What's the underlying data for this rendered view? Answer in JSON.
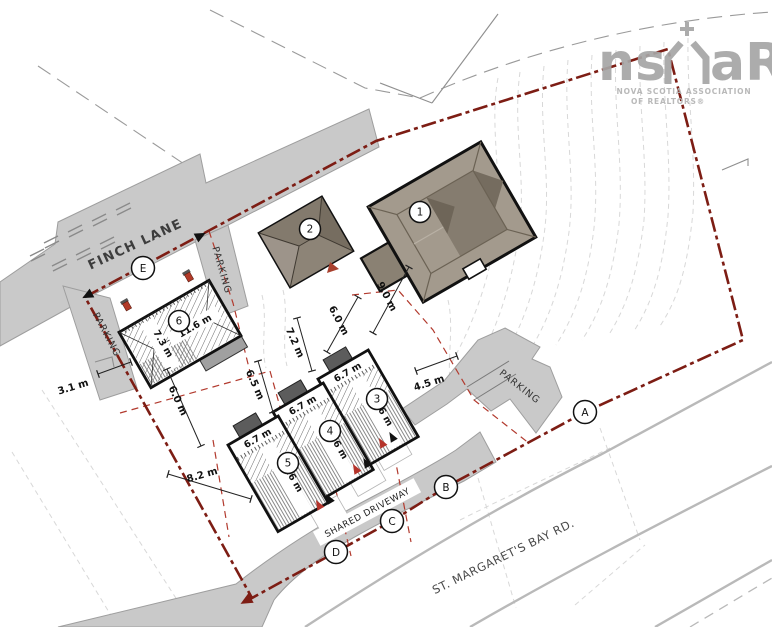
{
  "plan": {
    "roads": {
      "finch": "FINCH LANE",
      "stm": "ST. MARGARET'S BAY RD.",
      "shared": "SHARED DRIVEWAY",
      "parking": "PARKING"
    },
    "circ": {
      "a": "A",
      "b": "B",
      "c": "C",
      "d": "D",
      "e": "E",
      "n1": "1",
      "n2": "2",
      "n3": "3",
      "n4": "4",
      "n5": "5",
      "n6": "6"
    },
    "dim": {
      "d31": "3.1 m",
      "d60": "6.0 m",
      "d90": "9.0 m",
      "d72": "7.2 m",
      "d65": "6.5 m",
      "d45": "4.5 m",
      "d82": "8.2 m",
      "d67": "6.7 m",
      "d73": "7.3 m",
      "d116": "11.6 m"
    },
    "logo": {
      "ns": "ns",
      "ar": "aR",
      "line1": "NOVA SCOTIA ASSOCIATION",
      "line2": "OF REALTORS®"
    },
    "colors": {
      "boundary_red": "#7d1d14",
      "lot_line_red": "#b23a2e",
      "road_gray": "#c9c9c9",
      "building_tan": "#a39a8d",
      "contour_gray": "#d8d8d8"
    }
  }
}
